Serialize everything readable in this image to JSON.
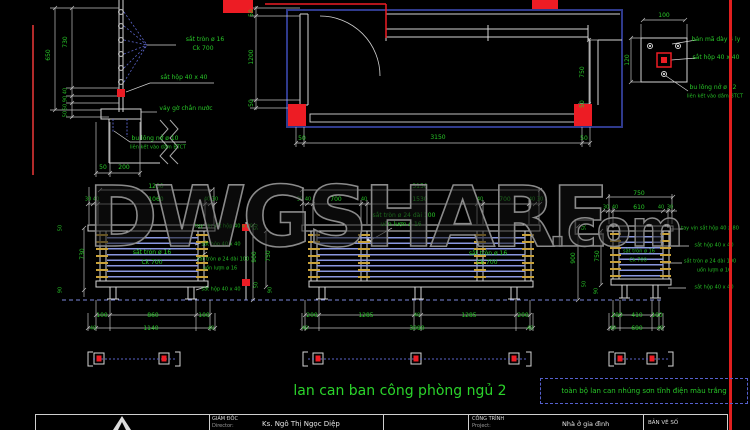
{
  "watermark": {
    "main": "DWGSHARE",
    "suffix": ".com"
  },
  "drawing": {
    "title": "lan can ban công phòng ngủ 2",
    "note": "toàn bộ lan can nhúng sơn tĩnh điện màu trắng"
  },
  "title_block": {
    "director_label": "GIÁM ĐỐC",
    "director_sub": "Director:",
    "director_name": "Ks. Ngô Thị Ngọc Diệp",
    "project_label": "CÔNG TRÌNH",
    "project_sub": "Project:",
    "project_name": "Nhà ở gia đình",
    "drawing_no_label": "BẢN VẼ SỐ"
  },
  "colors": {
    "background": "#000000",
    "line": "#d4d4d4",
    "dim_text_green": "#28c828",
    "highlight_red": "#ed1c24",
    "bar_blue": "#8a97e0",
    "dash_blue": "#5a64c8",
    "plan_navy": "#2f3a8c",
    "connector_gold": "#c9a23a"
  },
  "annotations": [
    {
      "t": "650",
      "x": 49,
      "y": 55,
      "r": -90
    },
    {
      "t": "730",
      "x": 66,
      "y": 42,
      "r": -90
    },
    {
      "t": "40",
      "x": 66,
      "y": 91,
      "r": -90,
      "cls": "sm"
    },
    {
      "t": "90",
      "x": 66,
      "y": 99,
      "r": -90,
      "cls": "sm"
    },
    {
      "t": "50",
      "x": 66,
      "y": 107,
      "r": -90,
      "cls": "sm"
    },
    {
      "t": "50",
      "x": 66,
      "y": 114,
      "r": -90,
      "cls": "sm"
    },
    {
      "t": "sắt tròn ø 16",
      "x": 205,
      "y": 40,
      "n": "material-label"
    },
    {
      "t": "Ck 700",
      "x": 203,
      "y": 49,
      "n": "material-label"
    },
    {
      "t": "sắt hộp 40 x 40",
      "x": 184,
      "y": 78,
      "n": "material-label"
    },
    {
      "t": "vảy gờ chắn nước",
      "x": 186,
      "y": 109,
      "n": "material-label"
    },
    {
      "t": "bu lông nở ø 10",
      "x": 155,
      "y": 139,
      "n": "material-label"
    },
    {
      "t": "liên kết vào dầm BTCT",
      "x": 158,
      "y": 148,
      "cls": "sm",
      "n": "material-label"
    },
    {
      "t": "50",
      "x": 103,
      "y": 168
    },
    {
      "t": "200",
      "x": 124,
      "y": 168
    },
    {
      "t": "50",
      "x": 252,
      "y": 13,
      "r": -90
    },
    {
      "t": "1200",
      "x": 252,
      "y": 57,
      "r": -90
    },
    {
      "t": "50",
      "x": 252,
      "y": 103,
      "r": -90
    },
    {
      "t": "750",
      "x": 583,
      "y": 72,
      "r": -90
    },
    {
      "t": "50",
      "x": 583,
      "y": 104,
      "r": -90
    },
    {
      "t": "50",
      "x": 302,
      "y": 139
    },
    {
      "t": "3150",
      "x": 438,
      "y": 138
    },
    {
      "t": "50",
      "x": 584,
      "y": 139
    },
    {
      "t": "100",
      "x": 664,
      "y": 16
    },
    {
      "t": "120",
      "x": 628,
      "y": 60,
      "r": -90
    },
    {
      "t": "bản mã dày 4 ly",
      "x": 716,
      "y": 40,
      "n": "material-label"
    },
    {
      "t": "sắt hộp 40 x 40",
      "x": 716,
      "y": 58,
      "n": "material-label"
    },
    {
      "t": "bu lông nở ø 12",
      "x": 713,
      "y": 88,
      "n": "material-label"
    },
    {
      "t": "liên kết vào dầm BTCT",
      "x": 715,
      "y": 97,
      "cls": "sm",
      "n": "material-label"
    },
    {
      "t": "1200",
      "x": 156,
      "y": 187
    },
    {
      "t": "30",
      "x": 88,
      "y": 200,
      "cls": "sm"
    },
    {
      "t": "40",
      "x": 96,
      "y": 200,
      "cls": "sm"
    },
    {
      "t": "1060",
      "x": 156,
      "y": 200
    },
    {
      "t": "40",
      "x": 207,
      "y": 200,
      "cls": "sm"
    },
    {
      "t": "30",
      "x": 215,
      "y": 200,
      "cls": "sm"
    },
    {
      "t": "730",
      "x": 83,
      "y": 254,
      "r": -90
    },
    {
      "t": "50",
      "x": 61,
      "y": 228,
      "r": -90,
      "cls": "sm"
    },
    {
      "t": "90",
      "x": 61,
      "y": 290,
      "r": -90,
      "cls": "sm"
    },
    {
      "t": "sắt tròn ø 16",
      "x": 152,
      "y": 253,
      "n": "material-label"
    },
    {
      "t": "Ck 700",
      "x": 152,
      "y": 263,
      "n": "material-label"
    },
    {
      "t": "tay vịn sắt hộp 40 x 80",
      "x": 224,
      "y": 227,
      "cls": "sm",
      "n": "material-label"
    },
    {
      "t": "sắt hộp 40 x 40",
      "x": 221,
      "y": 245,
      "cls": "sm",
      "n": "material-label"
    },
    {
      "t": "sắt tròn ø 24 dài 100",
      "x": 223,
      "y": 260,
      "cls": "sm",
      "n": "material-label"
    },
    {
      "t": "uốn lượn ø 16",
      "x": 220,
      "y": 269,
      "cls": "sm",
      "n": "material-label"
    },
    {
      "t": "sắt hộp 40 x 40",
      "x": 221,
      "y": 290,
      "cls": "sm",
      "n": "material-label"
    },
    {
      "t": "900",
      "x": 255,
      "y": 257,
      "r": -90
    },
    {
      "t": "750",
      "x": 269,
      "y": 256,
      "r": -90
    },
    {
      "t": "50",
      "x": 257,
      "y": 227,
      "r": -90,
      "cls": "sm"
    },
    {
      "t": "50",
      "x": 257,
      "y": 285,
      "r": -90,
      "cls": "sm"
    },
    {
      "t": "90",
      "x": 271,
      "y": 290,
      "r": -90,
      "cls": "sm"
    },
    {
      "t": "3150",
      "x": 420,
      "y": 187
    },
    {
      "t": "30",
      "x": 300,
      "y": 200,
      "cls": "sm"
    },
    {
      "t": "40",
      "x": 308,
      "y": 200,
      "cls": "sm"
    },
    {
      "t": "700",
      "x": 336,
      "y": 200
    },
    {
      "t": "40",
      "x": 364,
      "y": 200,
      "cls": "sm"
    },
    {
      "t": "1530",
      "x": 420,
      "y": 200
    },
    {
      "t": "40",
      "x": 480,
      "y": 200,
      "cls": "sm"
    },
    {
      "t": "700",
      "x": 505,
      "y": 200
    },
    {
      "t": "40",
      "x": 532,
      "y": 200,
      "cls": "sm"
    },
    {
      "t": "30",
      "x": 540,
      "y": 200,
      "cls": "sm"
    },
    {
      "t": "sắt tròn ø 24 dài 100",
      "x": 404,
      "y": 216,
      "n": "material-label"
    },
    {
      "t": "uốn lượn ø 16",
      "x": 401,
      "y": 225,
      "n": "material-label"
    },
    {
      "t": "sắt tròn ø 16",
      "x": 488,
      "y": 254,
      "n": "material-label"
    },
    {
      "t": "Ck 700",
      "x": 487,
      "y": 263,
      "n": "material-label"
    },
    {
      "t": "900",
      "x": 574,
      "y": 258,
      "r": -90
    },
    {
      "t": "750",
      "x": 598,
      "y": 256,
      "r": -90
    },
    {
      "t": "50",
      "x": 585,
      "y": 227,
      "r": -90,
      "cls": "sm"
    },
    {
      "t": "50",
      "x": 585,
      "y": 284,
      "r": -90,
      "cls": "sm"
    },
    {
      "t": "90",
      "x": 597,
      "y": 291,
      "r": -90,
      "cls": "sm"
    },
    {
      "t": "750",
      "x": 639,
      "y": 194
    },
    {
      "t": "30",
      "x": 606,
      "y": 208,
      "cls": "sm"
    },
    {
      "t": "40",
      "x": 615,
      "y": 208,
      "cls": "sm"
    },
    {
      "t": "610",
      "x": 639,
      "y": 208
    },
    {
      "t": "40",
      "x": 661,
      "y": 208,
      "cls": "sm"
    },
    {
      "t": "30",
      "x": 670,
      "y": 208,
      "cls": "sm"
    },
    {
      "t": "sắt tròn ø 16",
      "x": 639,
      "y": 252,
      "cls": "sm",
      "n": "material-label"
    },
    {
      "t": "Ck 700",
      "x": 638,
      "y": 261,
      "cls": "sm",
      "n": "material-label"
    },
    {
      "t": "tay vịn sắt hộp 40 x 80",
      "x": 710,
      "y": 229,
      "cls": "sm",
      "n": "material-label"
    },
    {
      "t": "sắt hộp 40 x 40",
      "x": 714,
      "y": 246,
      "cls": "sm",
      "n": "material-label"
    },
    {
      "t": "sắt tròn ø 24 dài 100",
      "x": 710,
      "y": 262,
      "cls": "sm",
      "n": "material-label"
    },
    {
      "t": "uốn lượn ø 16",
      "x": 714,
      "y": 271,
      "cls": "sm",
      "n": "material-label"
    },
    {
      "t": "sắt hộp 40 x 40",
      "x": 714,
      "y": 288,
      "cls": "sm",
      "n": "material-label"
    },
    {
      "t": "100",
      "x": 102,
      "y": 316
    },
    {
      "t": "860",
      "x": 153,
      "y": 316
    },
    {
      "t": "100",
      "x": 204,
      "y": 316
    },
    {
      "t": "40",
      "x": 93,
      "y": 329,
      "cls": "sm"
    },
    {
      "t": "1140",
      "x": 151,
      "y": 329
    },
    {
      "t": "40",
      "x": 211,
      "y": 329,
      "cls": "sm"
    },
    {
      "t": "200",
      "x": 312,
      "y": 316
    },
    {
      "t": "1285",
      "x": 366,
      "y": 316
    },
    {
      "t": "40",
      "x": 417,
      "y": 316,
      "cls": "sm"
    },
    {
      "t": "1285",
      "x": 469,
      "y": 316
    },
    {
      "t": "200",
      "x": 523,
      "y": 316
    },
    {
      "t": "40",
      "x": 305,
      "y": 329,
      "cls": "sm"
    },
    {
      "t": "3090",
      "x": 417,
      "y": 329
    },
    {
      "t": "40",
      "x": 530,
      "y": 329,
      "cls": "sm"
    },
    {
      "t": "100",
      "x": 617,
      "y": 316
    },
    {
      "t": "410",
      "x": 637,
      "y": 316
    },
    {
      "t": "100",
      "x": 657,
      "y": 316
    },
    {
      "t": "40",
      "x": 613,
      "y": 329,
      "cls": "sm"
    },
    {
      "t": "690",
      "x": 637,
      "y": 329
    },
    {
      "t": "40",
      "x": 660,
      "y": 329,
      "cls": "sm"
    }
  ]
}
